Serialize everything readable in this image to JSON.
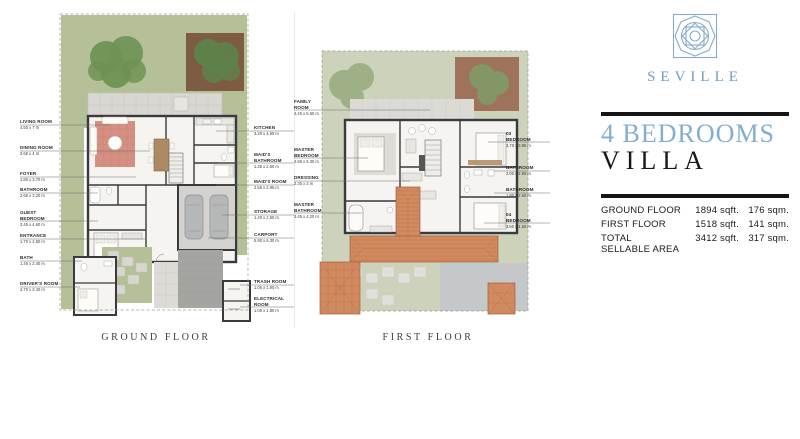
{
  "brand": {
    "name": "SEVILLE",
    "logo": "seville-ornament-logo"
  },
  "heading": {
    "line1": "4 BEDROOMS",
    "line2": "VILLA"
  },
  "area_table": {
    "rows": [
      {
        "label": "GROUND FLOOR",
        "sqft": "1894 sqft.",
        "sqm": "176 sqm."
      },
      {
        "label": "FIRST FLOOR",
        "sqft": "1518 sqft.",
        "sqm": "141 sqm."
      },
      {
        "label": "TOTAL SELLABLE AREA",
        "sqft": "3412 sqft.",
        "sqm": "317 sqm."
      }
    ]
  },
  "ground_floor": {
    "caption": "GROUND FLOOR",
    "labels_left": [
      {
        "name": "LIVING ROOM",
        "dim": "4.50 x 7 m"
      },
      {
        "name": "DINING ROOM",
        "dim": "3.65 x 4 m"
      },
      {
        "name": "FOYER",
        "dim": "1.80 x 3.70 m"
      },
      {
        "name": "BATHROOM",
        "dim": "2.65 x 3.20 m"
      },
      {
        "name": "GUEST BEDROOM",
        "dim": "3.45 x 4.60 m"
      },
      {
        "name": "ENTRANCE",
        "dim": "1.70 x 2.50 m"
      },
      {
        "name": "BATH",
        "dim": "1.45 x 2.40 m"
      },
      {
        "name": "DRIVER'S ROOM",
        "dim": "2.70 x 2.40 m"
      }
    ],
    "labels_right": [
      {
        "name": "KITCHEN",
        "dim": "3.20 x 4.60 m"
      },
      {
        "name": "MAID'S BATHROOM",
        "dim": "1.35 x 2.50 m"
      },
      {
        "name": "MAID'S ROOM",
        "dim": "2.55 x 2.95 m"
      },
      {
        "name": "STORAGE",
        "dim": "1.40 x 2.50 m"
      },
      {
        "name": "CARPORT",
        "dim": "5.90 x 6.30 m"
      },
      {
        "name": "TRASH ROOM",
        "dim": "1.05 x 1.90 m"
      },
      {
        "name": "ELECTRICAL ROOM",
        "dim": "1.05 x 1.90 m"
      }
    ]
  },
  "first_floor": {
    "caption": "FIRST FLOOR",
    "labels_left": [
      {
        "name": "FAMILY ROOM",
        "dim": "4.45 x 5.50 m"
      },
      {
        "name": "MASTER BEDROOM",
        "dim": "4.55 x 5.30 m"
      },
      {
        "name": "DRESSING",
        "dim": "2.30 x 3 m"
      },
      {
        "name": "MASTER BATHROOM",
        "dim": "3.45 x 4.20 m"
      }
    ],
    "labels_right": [
      {
        "name": "03 BEDROOM",
        "dim": "3.70 x 3.95 m"
      },
      {
        "name": "BATHROOM",
        "dim": "2.00 x 2.60 m"
      },
      {
        "name": "BATHROOM",
        "dim": "1.90 x 2.60 m"
      },
      {
        "name": "04 BEDROOM",
        "dim": "3.50 x 4.50 m"
      }
    ]
  },
  "colors": {
    "brand_blue": "#7fa9c9",
    "heading_blue": "#84aecd",
    "heading_dark": "#15151d",
    "bar_black": "#161616",
    "lawn_green": "#b6c098",
    "lawn_faded": "#cdd3bb",
    "roof_terracotta": "#d18a60",
    "wall_dark": "#3a3a3c"
  }
}
